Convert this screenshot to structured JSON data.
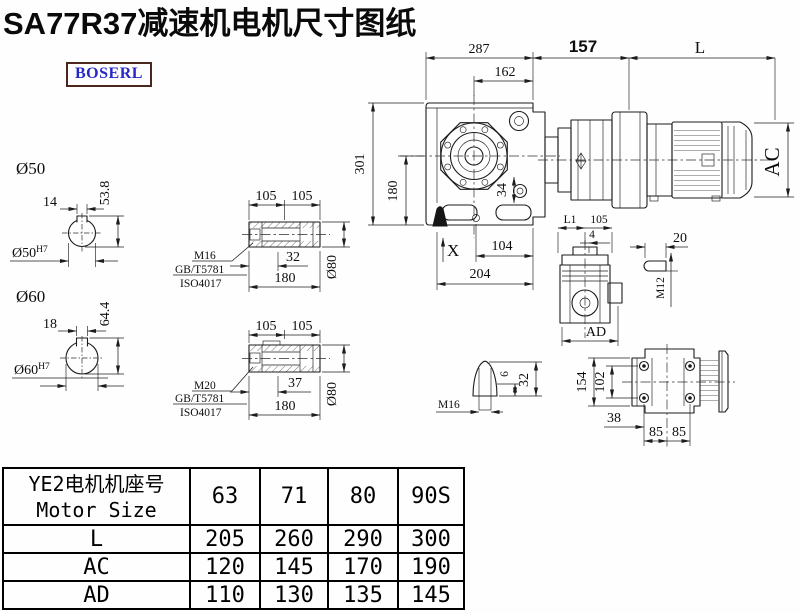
{
  "title": "SA77R37减速机电机尺寸图纸",
  "logo": "BOSERL",
  "main_view": {
    "width_total": "287",
    "width_inner": "162",
    "adapter_len": "157",
    "motor_len": "L",
    "height_total": "301",
    "height_lower": "180",
    "flange_offset": "34",
    "mark_x": "X",
    "bottom_inner": "104",
    "bottom_total": "204",
    "motor_dia": "AC"
  },
  "bore50": {
    "label": "Ø50",
    "key_width": "14",
    "key_depth": "53.8",
    "fit": "Ø50",
    "fit_tol": "H7"
  },
  "bore60": {
    "label": "Ø60",
    "key_width": "18",
    "key_depth": "64.4",
    "fit": "Ø60",
    "fit_tol": "H7"
  },
  "shaft_a": {
    "len1": "105",
    "len2": "105",
    "screw": "M16",
    "std1": "GB/T5781",
    "std2": "ISO4017",
    "depth": "32",
    "length": "180",
    "dia": "Ø80"
  },
  "shaft_b": {
    "len1": "105",
    "len2": "105",
    "screw": "M20",
    "std1": "GB/T5781",
    "std2": "ISO4017",
    "depth": "37",
    "length": "180",
    "dia": "Ø80"
  },
  "side_view": {
    "dim_l1": "L1",
    "dim_105": "105",
    "dim_4": "4",
    "dim_ad": "AD"
  },
  "key_detail": {
    "length": "20",
    "thread": "M12"
  },
  "plug_detail": {
    "dim_6": "6",
    "dim_32": "32",
    "thread": "M16"
  },
  "rear_view": {
    "height": "154",
    "hole_span_v": "102",
    "offset": "38",
    "hole_span_h1": "85",
    "hole_span_h2": "85"
  },
  "table": {
    "header_cn": "YE2电机机座号",
    "header_en": "Motor Size",
    "columns": [
      "63",
      "71",
      "80",
      "90S"
    ],
    "rows": [
      {
        "label": "L",
        "values": [
          "205",
          "260",
          "290",
          "300"
        ]
      },
      {
        "label": "AC",
        "values": [
          "120",
          "145",
          "170",
          "190"
        ]
      },
      {
        "label": "AD",
        "values": [
          "110",
          "130",
          "135",
          "145"
        ]
      }
    ]
  }
}
